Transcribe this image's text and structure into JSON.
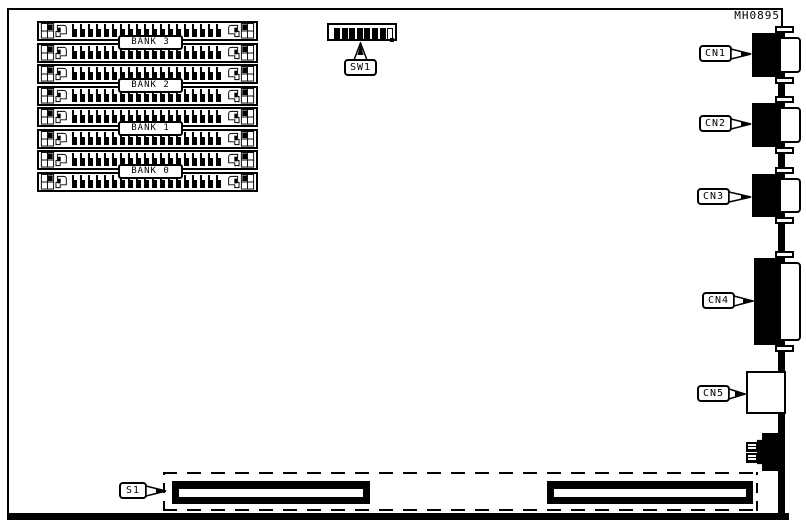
{
  "figure_id": "MH0895",
  "memory": {
    "socket_count": 8,
    "banks": [
      {
        "label": "BANK 3"
      },
      {
        "label": "BANK 2"
      },
      {
        "label": "BANK 1"
      },
      {
        "label": "BANK 0"
      }
    ]
  },
  "dip_switch": {
    "label": "SW1",
    "positions": [
      "on",
      "on",
      "on",
      "on",
      "on",
      "on",
      "on",
      "off"
    ]
  },
  "connectors": [
    {
      "id": "cn1",
      "label": "CN1",
      "type": "d-sub"
    },
    {
      "id": "cn2",
      "label": "CN2",
      "type": "d-sub"
    },
    {
      "id": "cn3",
      "label": "CN3",
      "type": "d-sub"
    },
    {
      "id": "cn4",
      "label": "CN4",
      "type": "d-sub"
    },
    {
      "id": "cn5",
      "label": "CN5",
      "type": "square"
    }
  ],
  "edge_connector": {
    "label": "S1",
    "segment_count": 2
  },
  "colors": {
    "line": "#000000",
    "background": "#ffffff"
  }
}
